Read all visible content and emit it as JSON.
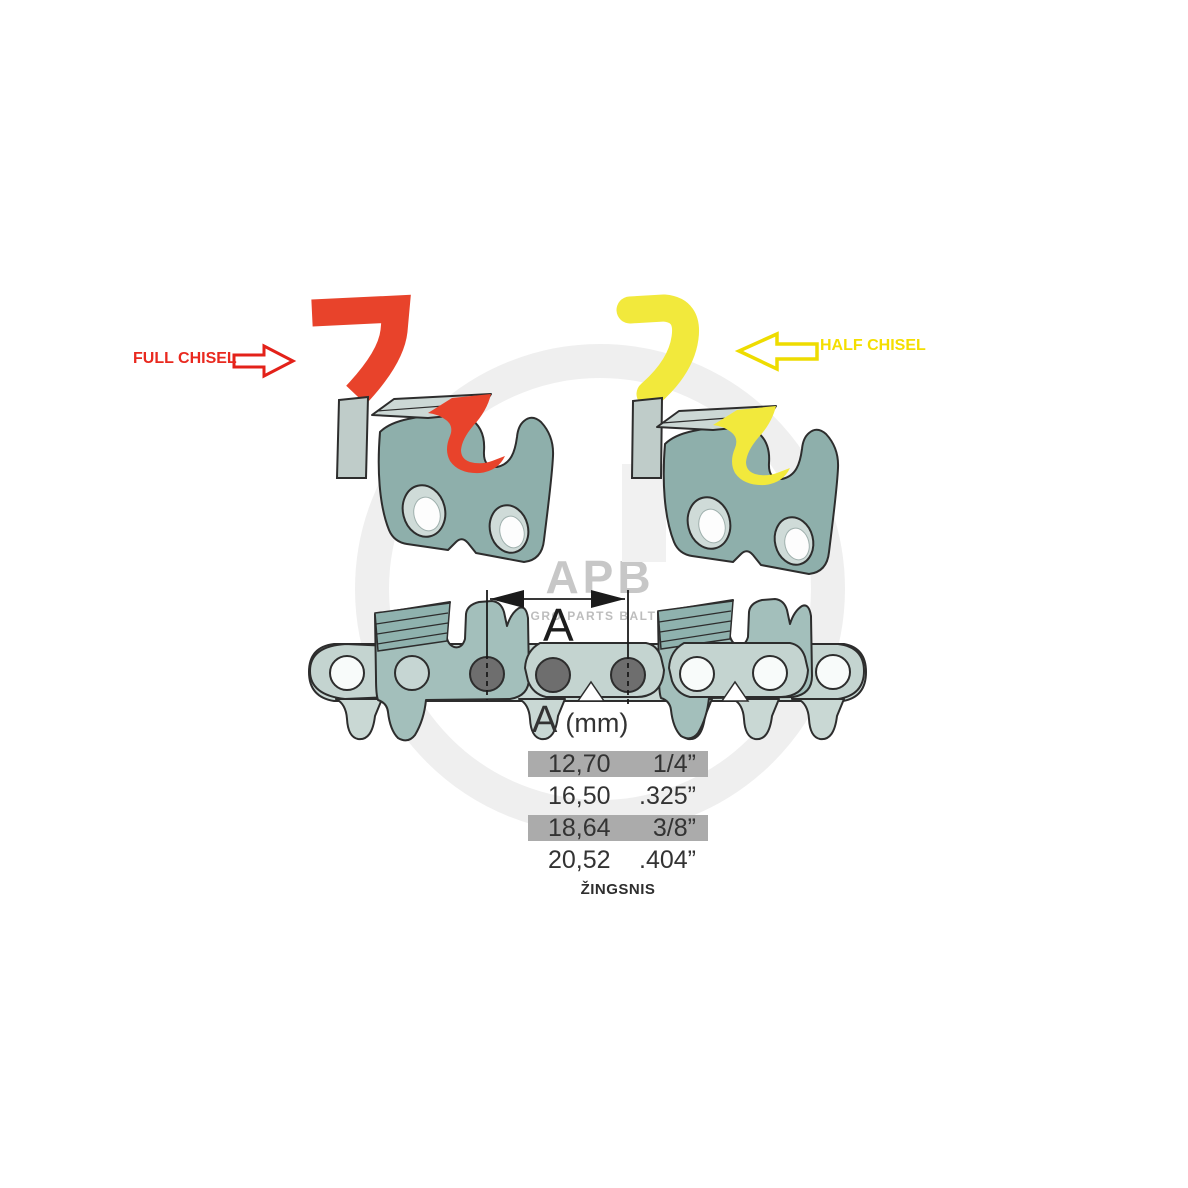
{
  "watermark": {
    "logo": "APB",
    "subtitle": "AGRO PARTS BALTIJA"
  },
  "annotations": {
    "full_chisel": {
      "label": "FULL CHISEL",
      "color": "#e9291f"
    },
    "half_chisel": {
      "label": "HALF CHISEL",
      "color": "#f4de00"
    }
  },
  "dimension": {
    "label": "A"
  },
  "pitch_table": {
    "title_symbol": "A",
    "title_unit": "(mm)",
    "rows": [
      {
        "mm": "12,70",
        "inches": "1/4”",
        "highlighted": true
      },
      {
        "mm": "16,50",
        "inches": ".325”",
        "highlighted": false
      },
      {
        "mm": "18,64",
        "inches": "3/8”",
        "highlighted": true
      },
      {
        "mm": "20,52",
        "inches": ".404”",
        "highlighted": false
      }
    ],
    "caption": "ŽINGSNIS"
  },
  "colors": {
    "full_chisel_accent": "#e8432b",
    "half_chisel_accent": "#f2e93c",
    "steel_teal": "#8eafab",
    "steel_light": "#c9d8d4",
    "rivet_gray": "#6e6e6e",
    "table_highlight": "#ababab",
    "watermark_gray": "#c7c7c7"
  }
}
